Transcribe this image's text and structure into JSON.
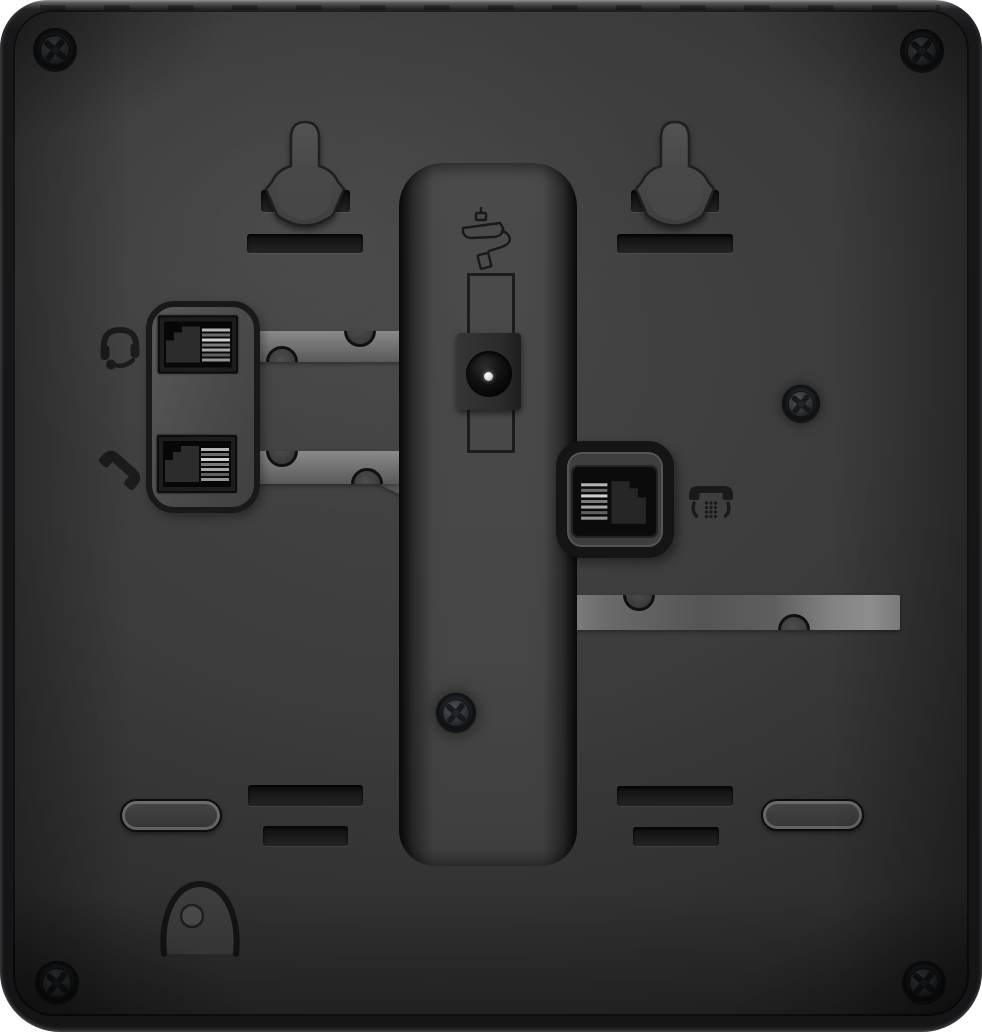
{
  "scene": {
    "title": "Rear panel of a black desk telephone",
    "type": "product-photo"
  },
  "colors": {
    "page_bg": "#ffffff",
    "shell": "#18181a",
    "panel": "#3c3c3c",
    "panel_highlight": "#454545",
    "panel_shadow": "#232323",
    "recess": "#4b4b4b",
    "channel": "#8a8a8a",
    "channel_dark": "#5a5a5a",
    "slot": "#1c1c1c",
    "plate": "#585858",
    "jack_cavity": "#070707",
    "plug_silhouette": "#2c2c2c",
    "contact": "#b8b8b8",
    "icon": "#1c1c1c",
    "pin": "#d9d9d9"
  },
  "icons": [
    {
      "name": "headset-icon",
      "meaning": "headset jack"
    },
    {
      "name": "handset-icon",
      "meaning": "handset jack"
    },
    {
      "name": "power-adapter-icon",
      "meaning": "DC power input"
    },
    {
      "name": "desk-phone-icon",
      "meaning": "telephone line jack"
    }
  ],
  "features": {
    "wall_mount_keyholes": 2,
    "corner_screws": 4,
    "panel_screws": 2,
    "modular_jacks_left": 2,
    "modular_jack_right": 1,
    "dc_power_jack": 1,
    "cable_routing_channels": 3,
    "kickstand_channel": 1,
    "bottom_slots": 4,
    "feet": 2,
    "cable_hook_recess": 1
  }
}
